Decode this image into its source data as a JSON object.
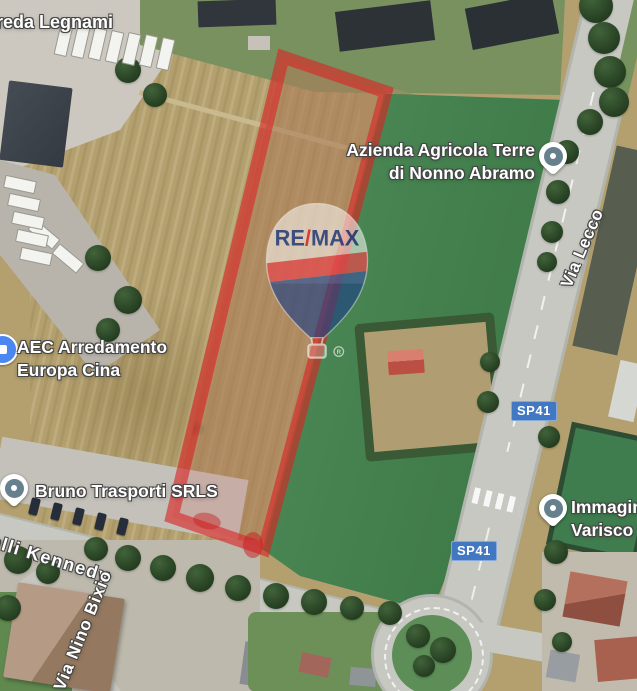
{
  "map": {
    "poi": {
      "legnami": {
        "label": "reda Legnami"
      },
      "azienda": {
        "line1": "Azienda Agricola Terre",
        "line2": "di Nonno Abramo"
      },
      "aec": {
        "line1": "AEC Arredamento",
        "line2": "Europa Cina"
      },
      "bruno": {
        "label": "Bruno Trasporti SRLS"
      },
      "immagine": {
        "line1": "Immagin",
        "line2": "Varisco P"
      }
    },
    "roads": {
      "via_lecco": "Via Lecco",
      "kennedy": "elli Kennedy",
      "nino_bixio": "Via Nino Bixio",
      "badge_north": "SP41",
      "badge_south": "SP41"
    },
    "watermark": {
      "re": "RE",
      "slash": "/",
      "max": "MAX",
      "reg": "R"
    },
    "overlay": {
      "color": "#da2525"
    },
    "colors": {
      "badge_blue": "#4277c2",
      "pin_inner": "#66808d",
      "aec_pin": "#4b87f0",
      "balloon_blue": "#1c3e85",
      "balloon_red": "#e0262b",
      "field_tan": "#b3a06e",
      "grass_green": "#4d8a57"
    }
  }
}
